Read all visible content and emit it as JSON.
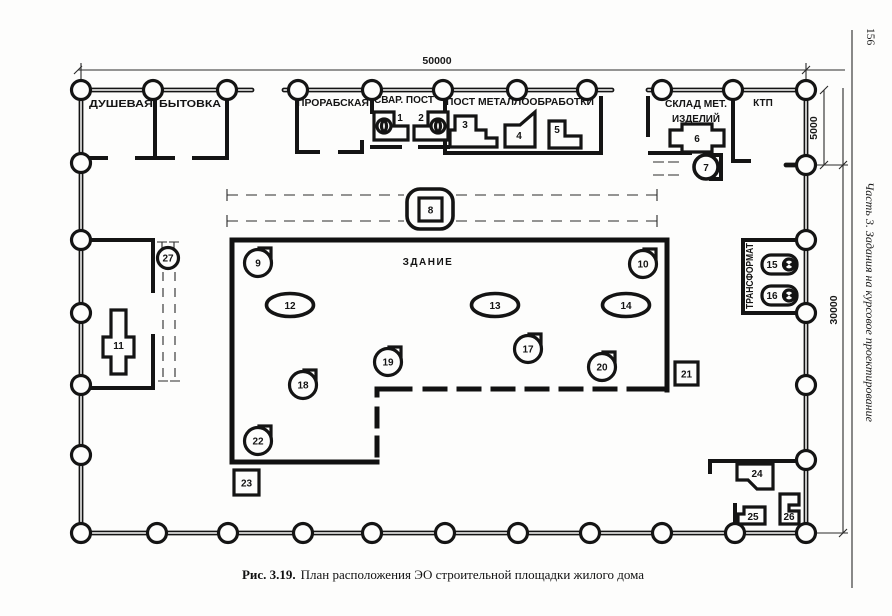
{
  "page": {
    "number": "156",
    "sidebar": "Часть 3. Задания на курсовое проектирование",
    "caption_prefix": "Рис. 3.19.",
    "caption_text": "План расположения ЭО строительной площадки жилого дома"
  },
  "dims": {
    "width": "50000",
    "offset": "5000",
    "height": "30000"
  },
  "labels": {
    "dushevaya": "ДУШЕВАЯ",
    "bytovka": "БЫТОВКА",
    "prorabskaya": "ПРОРАБСКАЯ",
    "svar_post": "СВАР. ПОСТ",
    "post_metall": "ПОСТ МЕТАЛЛООБРАБОТКИ",
    "sklad_line1": "СКЛАД МЕТ.",
    "sklad_line2": "ИЗДЕЛИЙ",
    "ktp": "КТП",
    "zdanie": "ЗДАНИЕ",
    "transformator": "ТРАНСФОРМАТ"
  },
  "markers": {
    "1": "1",
    "2": "2",
    "3": "3",
    "4": "4",
    "5": "5",
    "6": "6",
    "7": "7",
    "8": "8",
    "9": "9",
    "10": "10",
    "11": "11",
    "12": "12",
    "13": "13",
    "14": "14",
    "15": "15",
    "16": "16",
    "17": "17",
    "18": "18",
    "19": "19",
    "20": "20",
    "21": "21",
    "22": "22",
    "23": "23",
    "24": "24",
    "25": "25",
    "26": "26",
    "27": "27"
  }
}
